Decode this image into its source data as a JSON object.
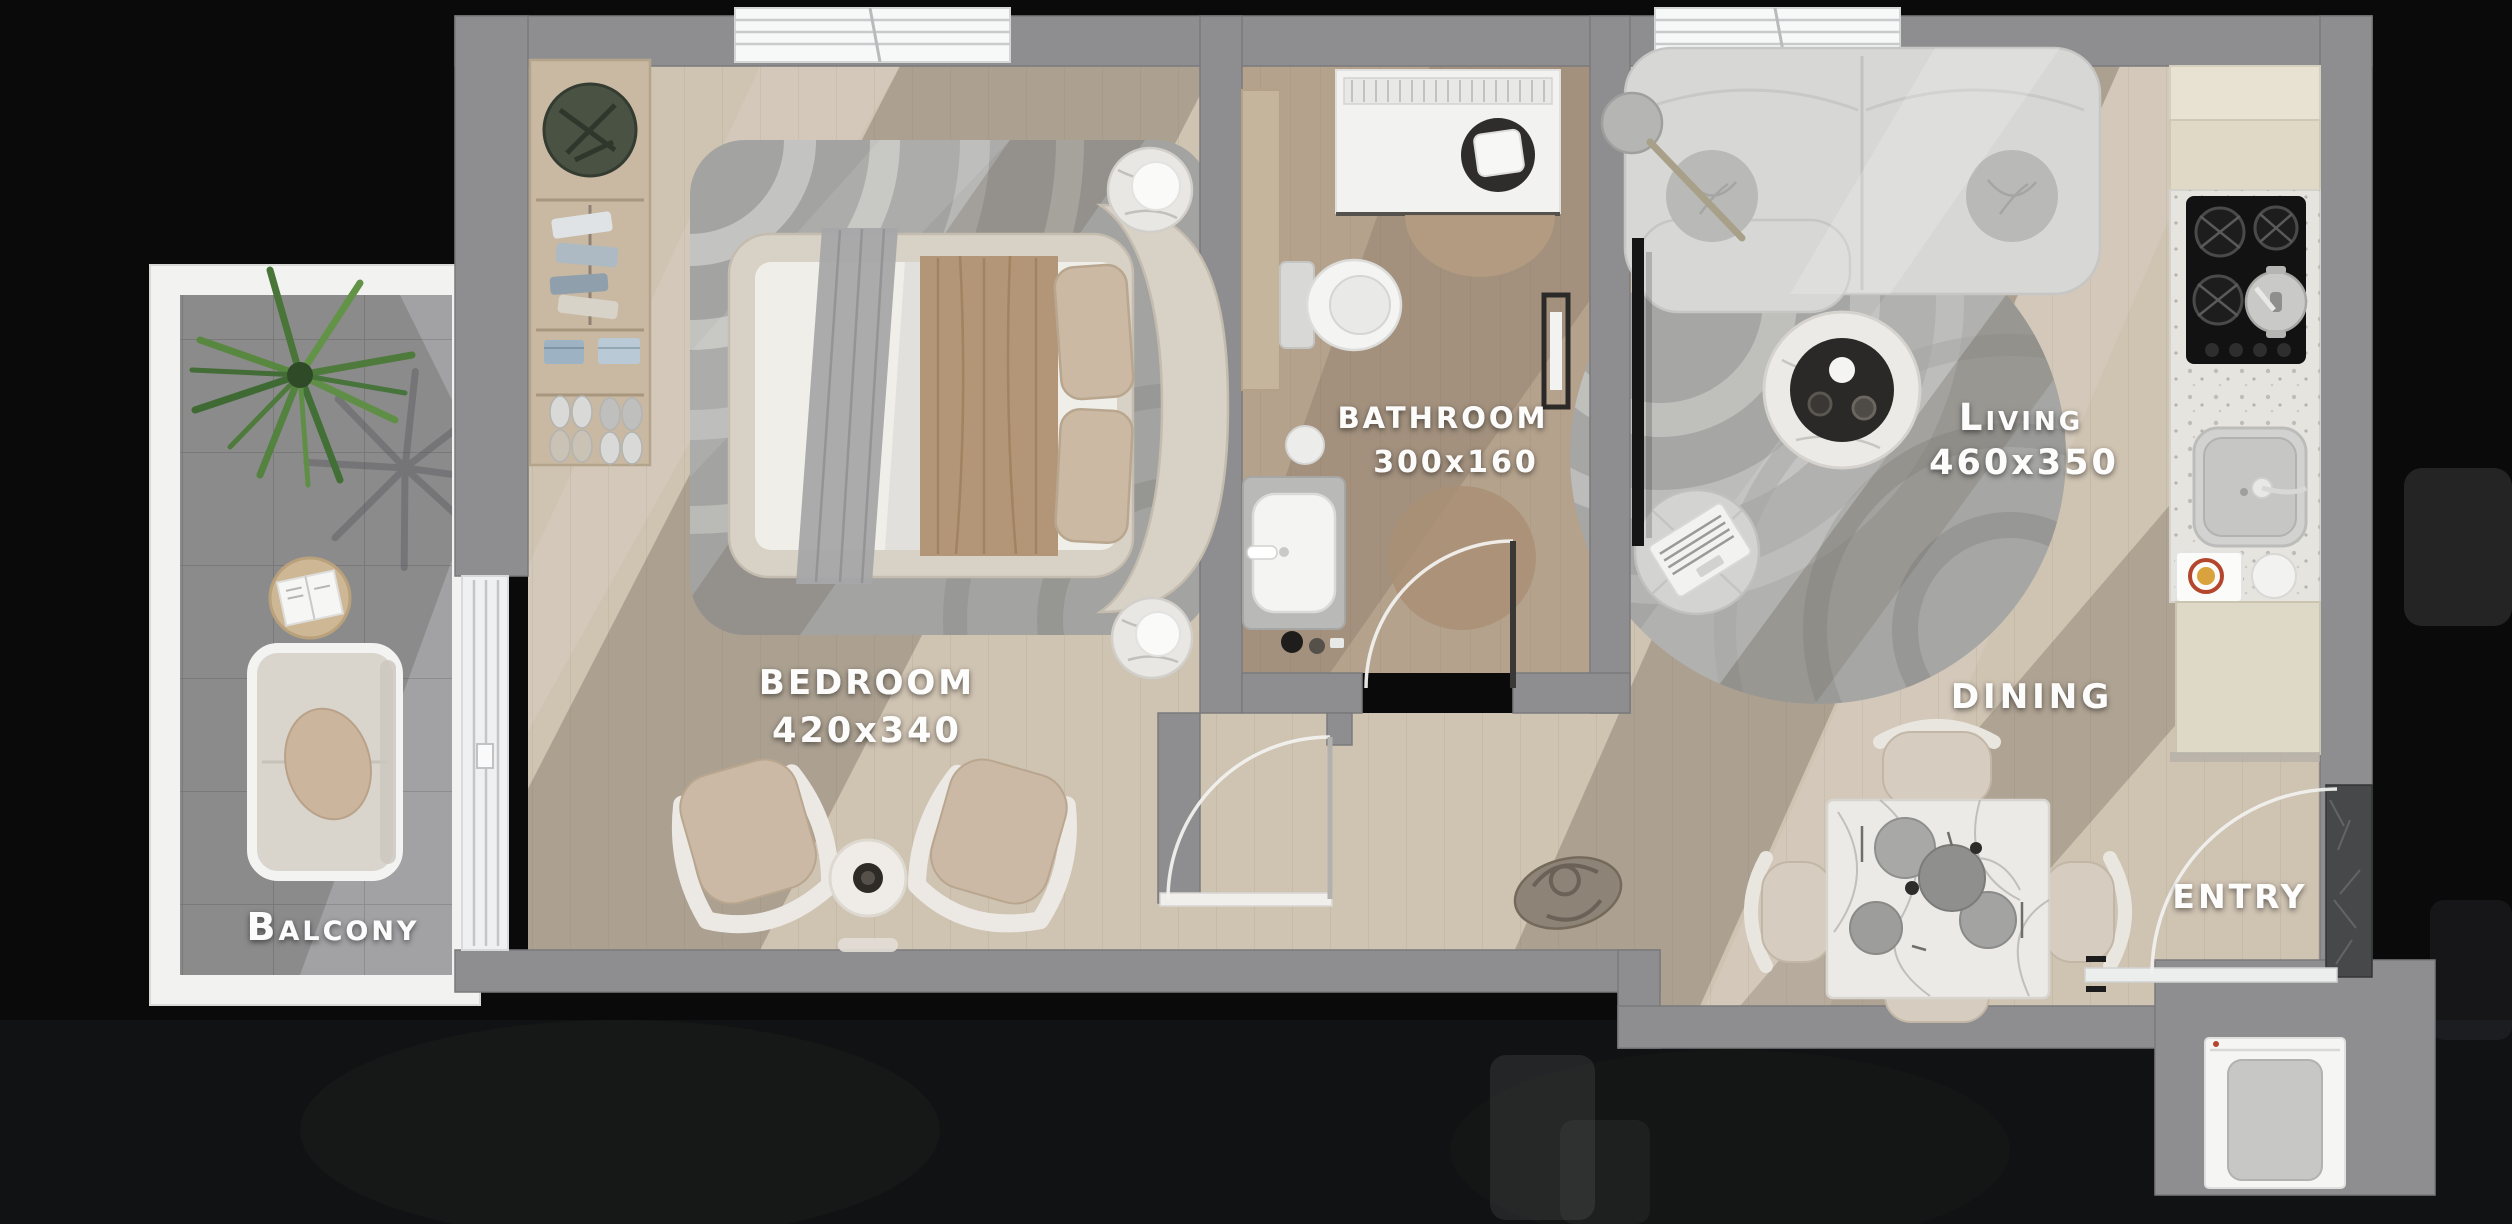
{
  "rooms": [
    {
      "id": "balcony",
      "label": "Balcony",
      "size": ""
    },
    {
      "id": "bedroom",
      "label": "BEDROOM",
      "size": "420x340"
    },
    {
      "id": "bathroom",
      "label": "BATHROOM",
      "size": "300x160"
    },
    {
      "id": "living",
      "label": "Living",
      "size": "460x350"
    },
    {
      "id": "dining",
      "label": "DINING",
      "size": ""
    },
    {
      "id": "entry",
      "label": "ENTRY",
      "size": ""
    }
  ],
  "colors": {
    "background": "#0a0a0b",
    "wall": "#8e8e90",
    "wood_floor": "#cfc3b2",
    "bathroom_floor": "#b4a28d",
    "balcony_tile": "#a2a2a4",
    "window_frame": "#f2f2f1",
    "rug": "#a6a6a4",
    "entry_marble_wall": "#47484a",
    "label_text": "#ffffff"
  }
}
